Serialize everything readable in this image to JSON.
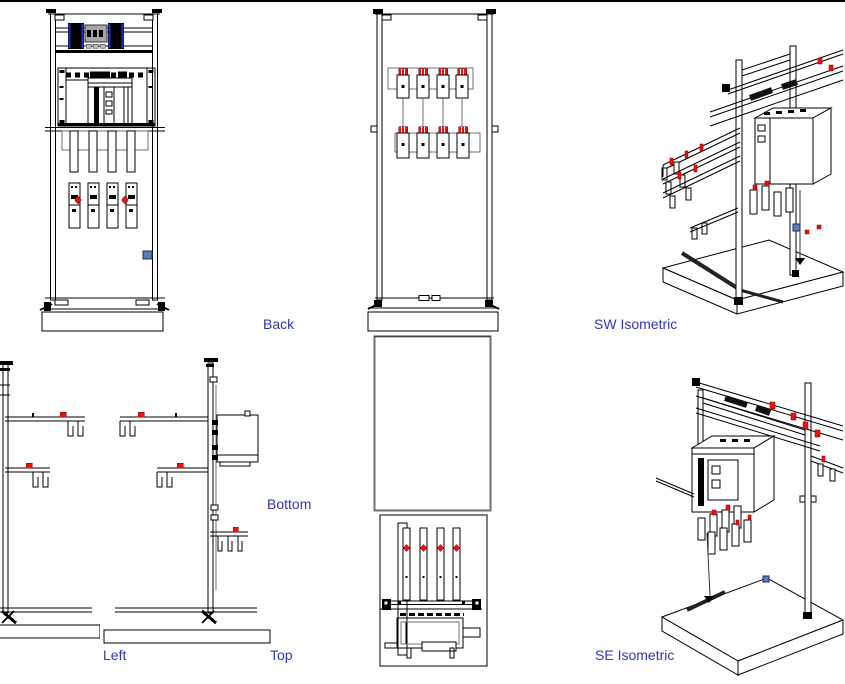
{
  "canvas": {
    "width_px": 845,
    "height_px": 684,
    "background": "#ffffff",
    "top_rule_color": "#000000"
  },
  "colors": {
    "line": "#000000",
    "secondary_line": "#707070",
    "label_text": "#3434b8",
    "accent_red": "#ee1111",
    "accent_blue": "#5b7fb4",
    "block_dark": "#111111",
    "block_blue_stripe": "#2233bb",
    "block_gray": "#a6a6a6"
  },
  "viewport_labels": {
    "back": "Back",
    "sw_isometric": "SW Isometric",
    "bottom": "Bottom",
    "left": "Left",
    "top": "Top",
    "se_isometric": "SE Isometric"
  }
}
